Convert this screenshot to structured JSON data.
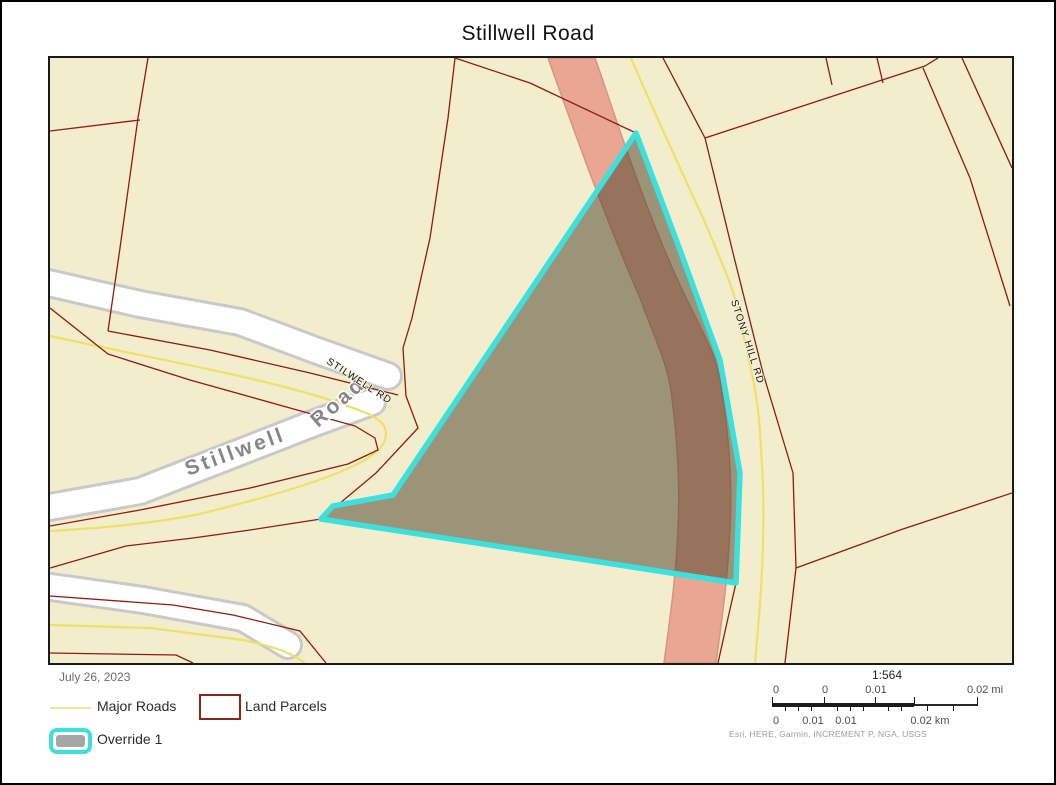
{
  "page": {
    "title": "Stillwell Road"
  },
  "map": {
    "road_labels": {
      "stillwell_big_1": "Stillwell",
      "stillwell_big_2": "Road",
      "stilwell_rd": "STILWELL RD",
      "stony_hill_rd": "STONY HILL RD"
    },
    "colors": {
      "parcel_background": "#f2edcc",
      "parcel_line": "#931b0e",
      "major_road_line": "#efe067",
      "highway_fill": "#e9a693",
      "local_road_fill": "#ffffff",
      "override_outline": "#3ce0dd"
    }
  },
  "footer": {
    "date": "July 26, 2023",
    "legend": [
      {
        "label": "Major Roads",
        "swatch": "yellow-line"
      },
      {
        "label": "Land Parcels",
        "swatch": "red-outline-box"
      },
      {
        "label": "Override 1",
        "swatch": "cyan-rounded-box"
      }
    ],
    "scale": {
      "ratio": "1:564",
      "mi_labels": [
        "0",
        "0",
        "0.01",
        "0.02 mi"
      ],
      "km_labels": [
        "0",
        "0.01",
        "0.01",
        "0.02 km"
      ],
      "attribution": "Esri, HERE, Garmin, INCREMENT P, NGA, USGS"
    }
  }
}
